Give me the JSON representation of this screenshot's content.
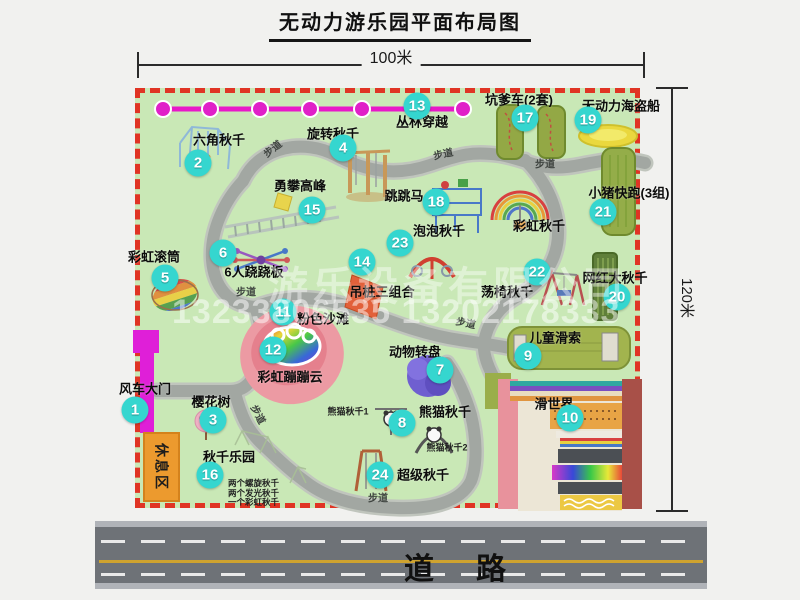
{
  "title": "无动力游乐园平面布局图",
  "dimensions": {
    "top": "100米",
    "right": "120米"
  },
  "road": {
    "label": "道路"
  },
  "rest_area": {
    "label": "休息区"
  },
  "walkway_label": "步道",
  "watermark": {
    "company": "游乐设备有限公司",
    "phone": "13233806535 13202178333"
  },
  "attractions": [
    {
      "num": "1",
      "name": "风车大门"
    },
    {
      "num": "2",
      "name": "六角秋千"
    },
    {
      "num": "3",
      "name": "樱花树"
    },
    {
      "num": "4",
      "name": "旋转秋千"
    },
    {
      "num": "5",
      "name": "彩虹滚筒"
    },
    {
      "num": "6",
      "name": "6人跷跷板"
    },
    {
      "num": "7",
      "name": "动物转盘"
    },
    {
      "num": "8",
      "name": "熊猫秋千"
    },
    {
      "num": "9",
      "name": "儿童滑索"
    },
    {
      "num": "10",
      "name": "滑世界"
    },
    {
      "num": "11",
      "name": "粉色沙滩"
    },
    {
      "num": "12",
      "name": "彩虹蹦蹦云"
    },
    {
      "num": "13",
      "name": "丛林穿越"
    },
    {
      "num": "14",
      "name": "吊桩三组合"
    },
    {
      "num": "15",
      "name": "勇攀高峰"
    },
    {
      "num": "16",
      "name": "秋千乐园"
    },
    {
      "num": "17",
      "name": "坑爹车(2套)"
    },
    {
      "num": "18",
      "name": "跳跳马"
    },
    {
      "num": "19",
      "name": "无动力海盗船"
    },
    {
      "num": "20",
      "name": "网红大秋千"
    },
    {
      "num": "21",
      "name": "小猪快跑(3组)"
    },
    {
      "num": "22",
      "name": "荡椅秋千"
    },
    {
      "num": "23",
      "name": "泡泡秋千"
    },
    {
      "num": "24",
      "name": "超级秋千"
    },
    {
      "num": "",
      "name": "彩虹秋千"
    }
  ],
  "sub_labels": {
    "panda": [
      "熊猫秋千1",
      "熊猫秋千2"
    ],
    "swing_park_notes": [
      "两个螺旋秋千",
      "两个发光秋千",
      "一个彩虹秋千"
    ]
  },
  "colors": {
    "map_green": "#c9e8b6",
    "border_red": "#e03424",
    "badge_teal": "#35d6cf",
    "gate_magenta": "#e01fd8",
    "rest_orange": "#ec9a2e",
    "road_gray": "#6e7277"
  }
}
